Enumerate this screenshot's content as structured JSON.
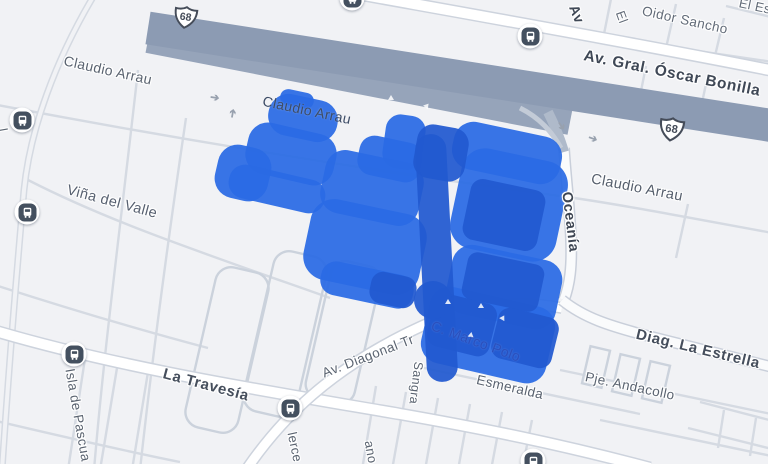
{
  "map": {
    "labels": {
      "claudio_arrau_1": "Claudio Arrau",
      "claudio_arrau_2": "Claudio Arrau",
      "claudio_arrau_3": "Claudio Arrau",
      "oscar_bonilla": "Av. Gral. Óscar Bonilla",
      "oidor_sancho": "Oidor Sancho",
      "vina_del_valle": "Viña del Valle",
      "la_travesia": "La Travesía",
      "oceania": "Oceanía",
      "diag_la_estrella": "Diag. La Estrella",
      "pje_andacollo": "Pje. Andacollo",
      "esmeralda": "Esmeralda",
      "av_diagonal": "Av. Diagonal Tr",
      "marco_polo": "C. Marco Polo",
      "sangra": "Sangra",
      "isla_de_pascua": "Isla de Pascua",
      "lerce": "lerce",
      "ano": "ano",
      "av_partial": "Av",
      "el_partial": "El",
      "el_es_partial": "El Es",
      "left_edge_partial": "l"
    },
    "shields": [
      {
        "number": "68"
      },
      {
        "number": "68"
      }
    ],
    "icons": {
      "bus_stop": "bus-stop-icon",
      "route_shield": "route-68-shield",
      "one_way_arrow": "one-way-arrow-icon"
    },
    "colors": {
      "highlight": "#2A6AE4",
      "highlight_dark": "#2159D0",
      "highway": "#8C9BB3",
      "background": "#F1F2F5",
      "label": "#5A6370",
      "label_dark": "#454E5C"
    }
  }
}
